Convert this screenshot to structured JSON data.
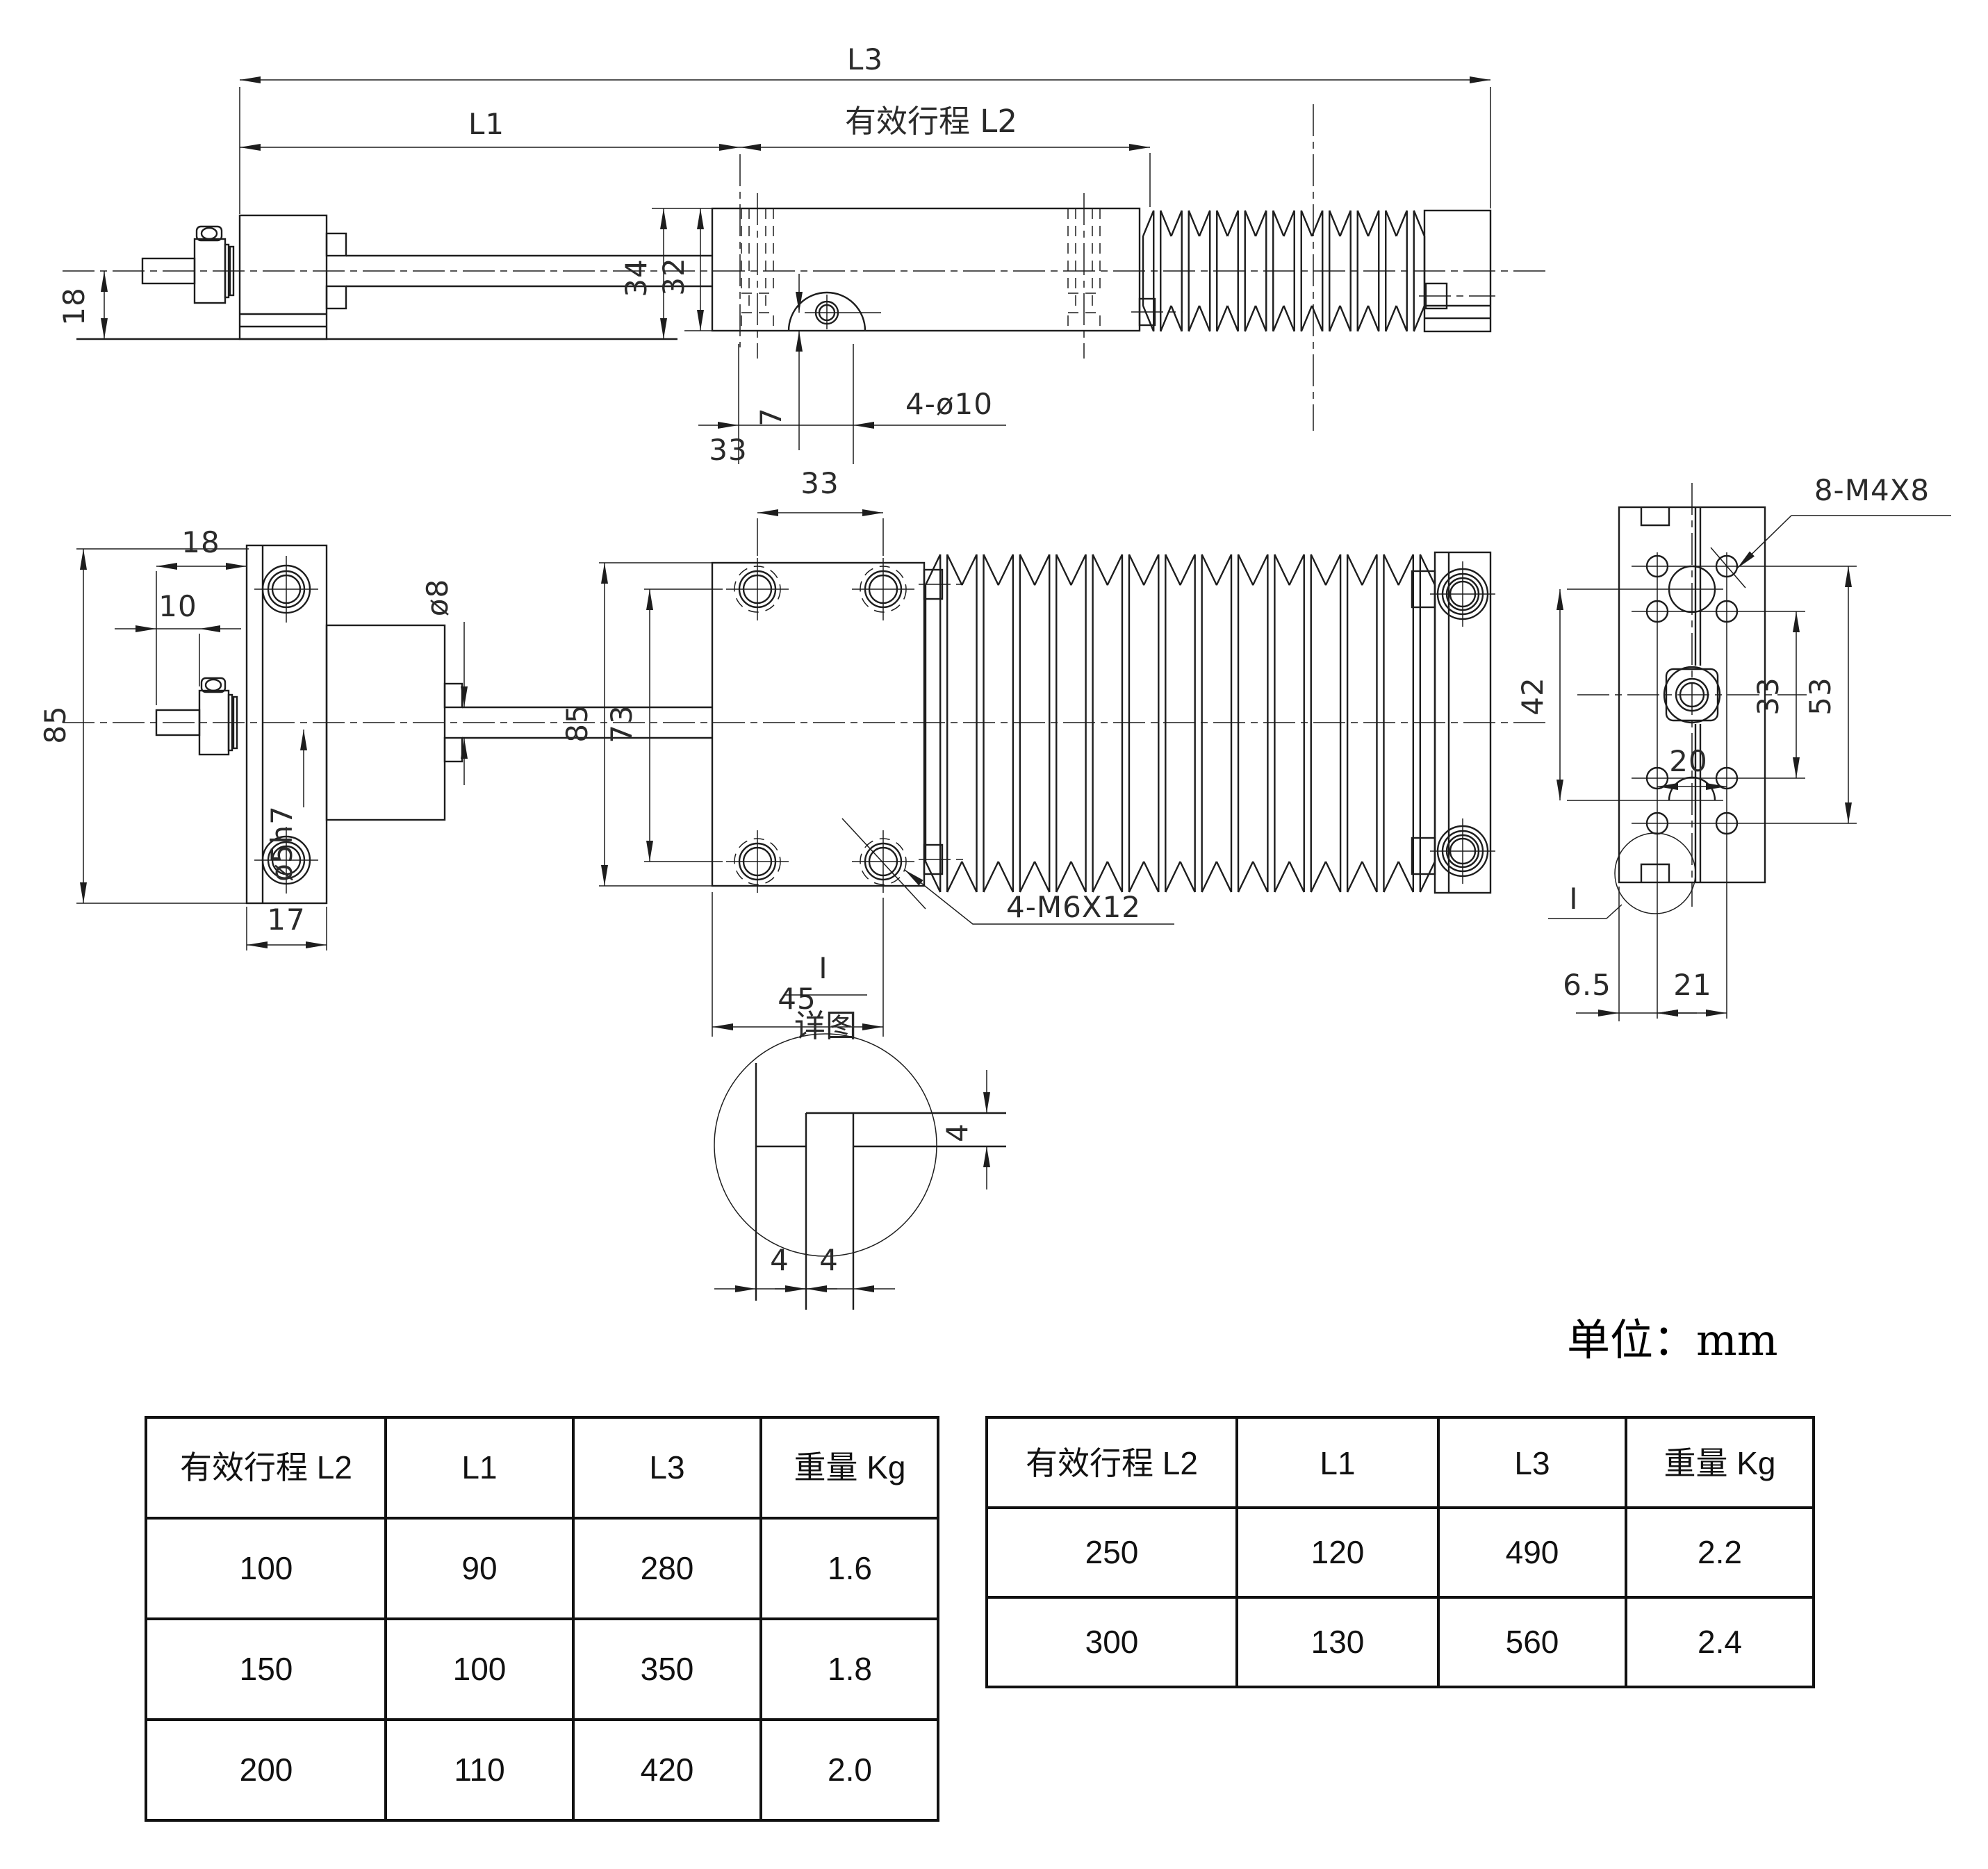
{
  "unit_note": "单位：mm",
  "side_view": {
    "l3": "L3",
    "l1": "L1",
    "l2": "有效行程  L2",
    "d34": "34",
    "d32": "32",
    "d18": "18",
    "d7": "7",
    "d33": "33",
    "holes": "4-ø10"
  },
  "plan_view": {
    "d85_left": "85",
    "d18": "18",
    "d10": "10",
    "d8": "ø8",
    "d5h7": "ø5h7",
    "d17": "17",
    "d85_mid": "85",
    "d73": "73",
    "d33": "33",
    "d45": "45",
    "holes": "4-M6X12"
  },
  "end_view": {
    "holes": "8-M4X8",
    "d42": "42",
    "d33": "33",
    "d53": "53",
    "d20": "20",
    "d65": "6.5",
    "d21": "21",
    "detail_ref": "I"
  },
  "detail_view": {
    "ref": "I",
    "caption": "详图",
    "d4r": "4",
    "d4a": "4",
    "d4b": "4"
  },
  "tables": {
    "left": {
      "headers": [
        "有效行程 L2",
        "L1",
        "L3",
        "重量 Kg"
      ],
      "rows": [
        [
          "100",
          "90",
          "280",
          "1.6"
        ],
        [
          "150",
          "100",
          "350",
          "1.8"
        ],
        [
          "200",
          "110",
          "420",
          "2.0"
        ]
      ]
    },
    "right": {
      "headers": [
        "有效行程 L2",
        "L1",
        "L3",
        "重量 Kg"
      ],
      "rows": [
        [
          "250",
          "120",
          "490",
          "2.2"
        ],
        [
          "300",
          "130",
          "560",
          "2.4"
        ]
      ]
    }
  }
}
